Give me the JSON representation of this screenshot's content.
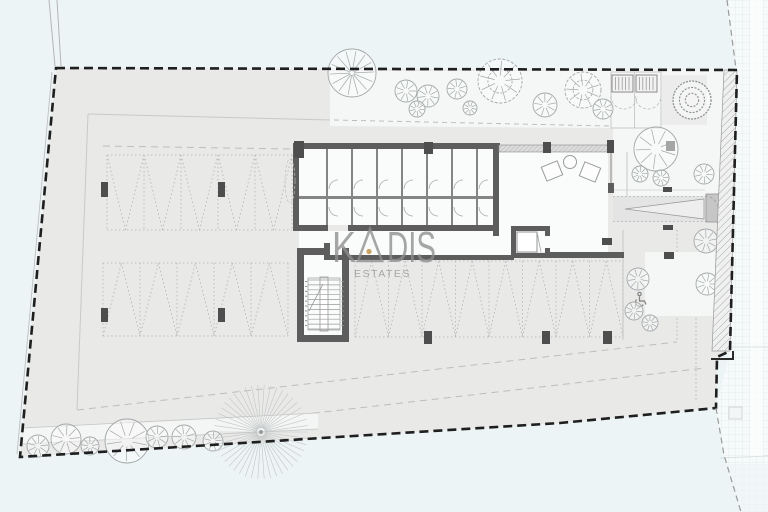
{
  "watermark": {
    "brand_k": "K",
    "brand_dis": "DIS",
    "subtitle": "ESTATES",
    "text_color": "#8e8e8e",
    "dot_color": "#c7a263"
  },
  "colors": {
    "background": "#ecf4f5",
    "parcel_fill": "#e9e9e8",
    "garden_fill": "#f5f6f6",
    "room_fill": "#fafbfb",
    "wall_dark": "#5d5d5d",
    "partition": "#858585",
    "boundary_dash": "#1f1f1f",
    "thin_line": "#c9c9c9",
    "dotted_line": "#b2b2b2",
    "tree_stroke": "#a3a8a8",
    "road_grid": "#dfe8e8",
    "hatch_stroke": "#9aa3a3",
    "column_fill": "#4e4e4e"
  },
  "plan": {
    "boundary_points": [
      [
        56,
        68
      ],
      [
        737,
        70
      ],
      [
        730,
        351
      ],
      [
        717,
        357
      ],
      [
        716,
        408
      ],
      [
        560,
        423
      ],
      [
        20,
        457
      ]
    ],
    "hatch_strip_points": [
      [
        724,
        70
      ],
      [
        737,
        70
      ],
      [
        730,
        351
      ],
      [
        712,
        351
      ]
    ],
    "road_points": [
      [
        727,
        0
      ],
      [
        768,
        0
      ],
      [
        768,
        512
      ],
      [
        741,
        512
      ],
      [
        724,
        455
      ],
      [
        716,
        408
      ],
      [
        730,
        351
      ],
      [
        736,
        70
      ]
    ],
    "walkway_band_points": [
      [
        23,
        428
      ],
      [
        318,
        413
      ],
      [
        318,
        429
      ],
      [
        23,
        444
      ]
    ],
    "parking_rows": [
      {
        "x1": 107,
        "x2": 292,
        "y1": 155,
        "y2": 230,
        "stalls": 5,
        "apex": "down"
      },
      {
        "x1": 103,
        "x2": 288,
        "y1": 263,
        "y2": 336,
        "stalls": 5,
        "apex": "up"
      },
      {
        "x1": 355,
        "x2": 623,
        "y1": 261,
        "y2": 337,
        "stalls": 8,
        "apex": "up"
      }
    ],
    "columns": [
      [
        101,
        182,
        7,
        15
      ],
      [
        218,
        182,
        7,
        15
      ],
      [
        101,
        308,
        7,
        14
      ],
      [
        218,
        308,
        7,
        14
      ],
      [
        424,
        331,
        8,
        13
      ],
      [
        542,
        331,
        8,
        13
      ],
      [
        603,
        331,
        9,
        13
      ],
      [
        294,
        141,
        10,
        17
      ],
      [
        424,
        142,
        9,
        12
      ],
      [
        543,
        142,
        8,
        11
      ],
      [
        607,
        140,
        7,
        13
      ],
      [
        666,
        141,
        9,
        10
      ],
      [
        663,
        187,
        9,
        5
      ],
      [
        663,
        225,
        10,
        5
      ],
      [
        664,
        252,
        10,
        7
      ],
      [
        602,
        238,
        10,
        7
      ]
    ],
    "trees": [
      {
        "style": "palm",
        "x": 352,
        "y": 73,
        "r": 24
      },
      {
        "style": "round",
        "x": 406,
        "y": 91,
        "r": 11
      },
      {
        "style": "round",
        "x": 428,
        "y": 96,
        "r": 11
      },
      {
        "style": "round",
        "x": 417,
        "y": 109,
        "r": 8
      },
      {
        "style": "round",
        "x": 457,
        "y": 89,
        "r": 10
      },
      {
        "style": "swirl",
        "x": 500,
        "y": 81,
        "r": 22
      },
      {
        "style": "round",
        "x": 470,
        "y": 108,
        "r": 7
      },
      {
        "style": "round",
        "x": 545,
        "y": 105,
        "r": 12
      },
      {
        "style": "swirl",
        "x": 583,
        "y": 90,
        "r": 18
      },
      {
        "style": "round",
        "x": 603,
        "y": 109,
        "r": 10
      },
      {
        "style": "bush",
        "x": 692,
        "y": 100,
        "r": 19
      },
      {
        "style": "round",
        "x": 656,
        "y": 149,
        "r": 22
      },
      {
        "style": "round",
        "x": 640,
        "y": 174,
        "r": 8
      },
      {
        "style": "round",
        "x": 661,
        "y": 178,
        "r": 8
      },
      {
        "style": "round",
        "x": 704,
        "y": 174,
        "r": 10
      },
      {
        "style": "round",
        "x": 706,
        "y": 241,
        "r": 12
      },
      {
        "style": "round",
        "x": 638,
        "y": 279,
        "r": 11
      },
      {
        "style": "round",
        "x": 707,
        "y": 284,
        "r": 11
      },
      {
        "style": "round",
        "x": 634,
        "y": 311,
        "r": 9
      },
      {
        "style": "round",
        "x": 650,
        "y": 323,
        "r": 8
      },
      {
        "style": "round",
        "x": 38,
        "y": 446,
        "r": 11
      },
      {
        "style": "round",
        "x": 66,
        "y": 439,
        "r": 15
      },
      {
        "style": "round",
        "x": 90,
        "y": 446,
        "r": 9
      },
      {
        "style": "round",
        "x": 127,
        "y": 441,
        "r": 22
      },
      {
        "style": "round",
        "x": 157,
        "y": 437,
        "r": 11
      },
      {
        "style": "round",
        "x": 184,
        "y": 437,
        "r": 12
      },
      {
        "style": "round",
        "x": 213,
        "y": 441,
        "r": 10
      }
    ],
    "sunburst": {
      "x": 261,
      "y": 432,
      "r": 47
    }
  }
}
